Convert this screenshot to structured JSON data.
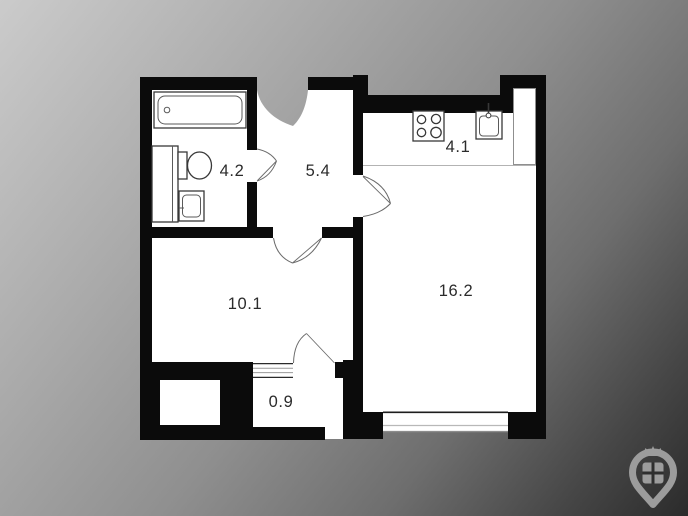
{
  "background": {
    "gradient_start": "#cbcbcb",
    "gradient_end": "#2b2b2b"
  },
  "floorplan": {
    "wall_color": "#0b0b0b",
    "floor_color": "#ffffff",
    "label_color": "#2b2b2b",
    "rooms": {
      "bathroom": {
        "label": "4.2"
      },
      "hallway": {
        "label": "5.4"
      },
      "kitchen": {
        "label": "4.1"
      },
      "bedroom": {
        "label": "10.1"
      },
      "living_room": {
        "label": "16.2"
      },
      "entry": {
        "label": "0.9"
      }
    }
  },
  "logo": {
    "icon": "house-location-pin",
    "color": "#9c9c9c"
  }
}
